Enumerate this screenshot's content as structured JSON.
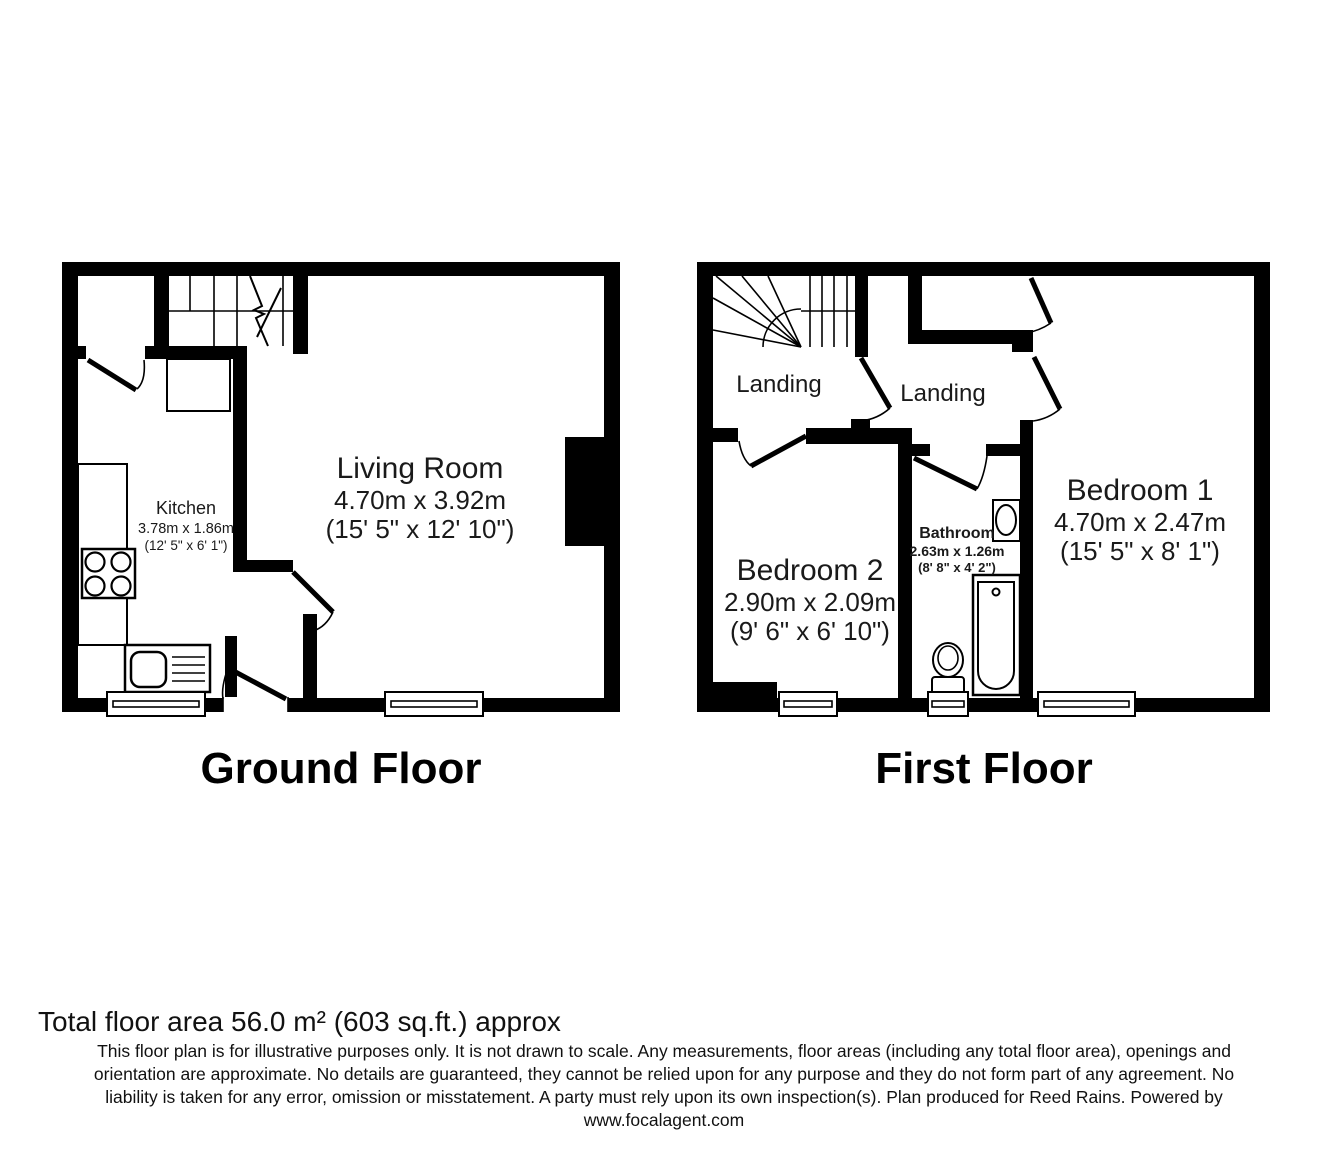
{
  "colors": {
    "wall": "#000000",
    "background": "#ffffff",
    "text": "#1a1a1a"
  },
  "ground_floor": {
    "caption": "Ground Floor",
    "rooms": {
      "kitchen": {
        "name": "Kitchen",
        "dims_metric": "3.78m x 1.86m",
        "dims_imperial": "(12' 5\" x 6' 1\")"
      },
      "living_room": {
        "name": "Living Room",
        "dims_metric": "4.70m x 3.92m",
        "dims_imperial": "(15' 5\" x 12' 10\")"
      }
    }
  },
  "first_floor": {
    "caption": "First Floor",
    "rooms": {
      "landing_left": {
        "name": "Landing"
      },
      "landing_right": {
        "name": "Landing"
      },
      "bedroom2": {
        "name": "Bedroom 2",
        "dims_metric": "2.90m x 2.09m",
        "dims_imperial": "(9' 6\" x 6' 10\")"
      },
      "bathroom": {
        "name": "Bathroom",
        "dims_metric": "2.63m x 1.26m",
        "dims_imperial": "(8' 8\" x 4' 2\")"
      },
      "bedroom1": {
        "name": "Bedroom 1",
        "dims_metric": "4.70m x 2.47m",
        "dims_imperial": "(15' 5\" x 8' 1\")"
      }
    }
  },
  "footer": {
    "total_area": "Total floor area 56.0 m² (603 sq.ft.) approx",
    "disclaimer_lines": [
      "This floor plan is for illustrative purposes only. It is not drawn to scale. Any measurements, floor areas (including any total floor area), openings and",
      "orientation are approximate. No details are guaranteed, they cannot be relied upon for any purpose and they do not form part of any agreement. No",
      "liability is taken for any error, omission or misstatement. A party must rely upon its own inspection(s). Plan produced for Reed Rains. Powered by",
      "www.focalagent.com"
    ]
  }
}
